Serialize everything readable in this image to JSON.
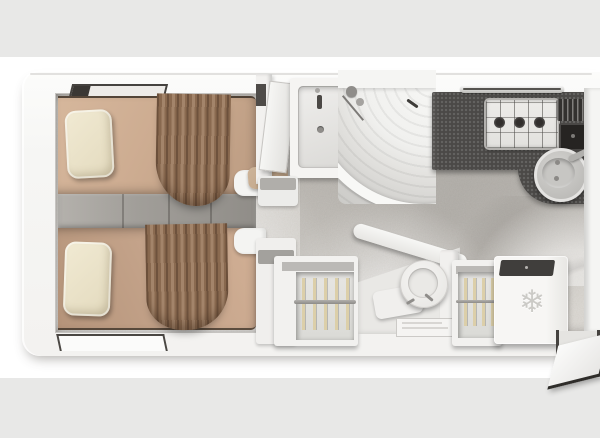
{
  "scene": {
    "type": "motorhome-floorplan-3d-top-view",
    "background_band_color": "#e8e8e7",
    "shell_color": "#f6f6f4",
    "floor_color": "#d5d2cd"
  },
  "bedroom": {
    "bed_count": 2,
    "beds": [
      {
        "name": "twin-bed-top",
        "mattress_color": "#cdac91",
        "pillow_color": "#ece4cc",
        "curtain_color": "#8a6a50"
      },
      {
        "name": "twin-bed-bottom",
        "mattress_color": "#c4a38a",
        "pillow_color": "#ece4cc",
        "curtain_color": "#8a6a50"
      }
    ],
    "center_steps": {
      "step_count": 3,
      "color": "#9d9a95"
    },
    "windows": [
      {
        "name": "window-top-wall"
      },
      {
        "name": "window-bottom-wall"
      }
    ]
  },
  "bathroom": {
    "vanity": {
      "basin_shape": "rectangular",
      "door_state": "open"
    },
    "shower": {
      "shape": "quarter-circle",
      "door": "curved-sliding",
      "tray_ribbed": true
    }
  },
  "kitchen": {
    "counter_color": "#4b4947",
    "hob": {
      "burner_count": 3,
      "burner_color": "#322f2d"
    },
    "utensil_drainer": true,
    "sink": {
      "shape": "round",
      "color": "#c0bfbc",
      "drain_count": 2
    },
    "light_strip": true
  },
  "utility": {
    "wardrobes": [
      {
        "name": "wardrobe-left",
        "hanger_count": 5,
        "hanger_color": "#dccfa9"
      },
      {
        "name": "wardrobe-right",
        "hanger_count": 4,
        "hanger_color": "#dccfa9"
      }
    ],
    "toilet": {
      "shape": "round"
    },
    "fridge": {
      "snowflake_glyph": "❄",
      "top_color": "#403e3c"
    }
  },
  "entry": {
    "door_state": "open"
  }
}
